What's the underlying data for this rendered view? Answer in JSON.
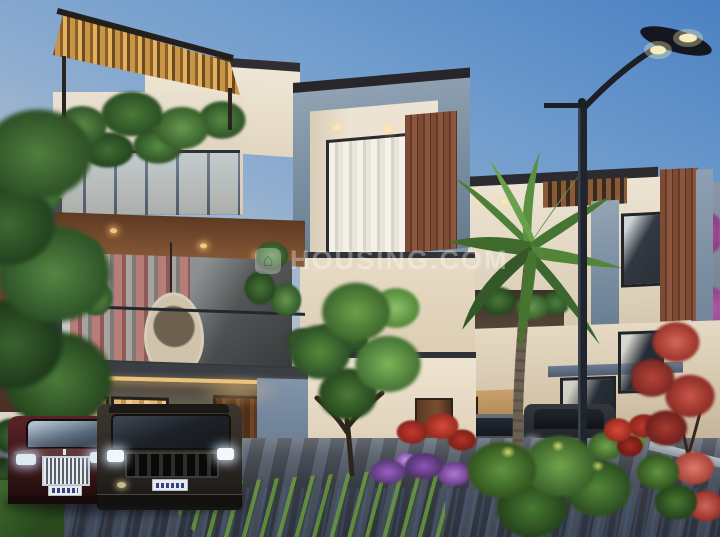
{
  "scene": {
    "type": "architectural-3d-render",
    "subject": "Modern triplex luxury villas at dusk with landscaped driveway, parked cars, palm tree and street lamp",
    "watermark": {
      "text": "HOUSING.COM",
      "logo_icon": "house-icon",
      "logo_glyph": "⌂"
    }
  },
  "palette": {
    "sky_top": "#4b80c2",
    "sky_mid": "#8fadd0",
    "sky_horizon": "#e7dcc8",
    "stone_gray": "#8397aa",
    "wall_cream": "#ece3d2",
    "wood_brown": "#7c4b33",
    "pergola_gold": "#c89445",
    "foliage_green": "#3f6a33",
    "palm_green": "#5c8f3f",
    "bougainvillea_magenta": "#c058b0",
    "accent_warm_light": "#f0c27a",
    "pavement_dark": "#3d4149",
    "car_maroon": "#4a1f20",
    "car_gray": "#3c3630"
  }
}
